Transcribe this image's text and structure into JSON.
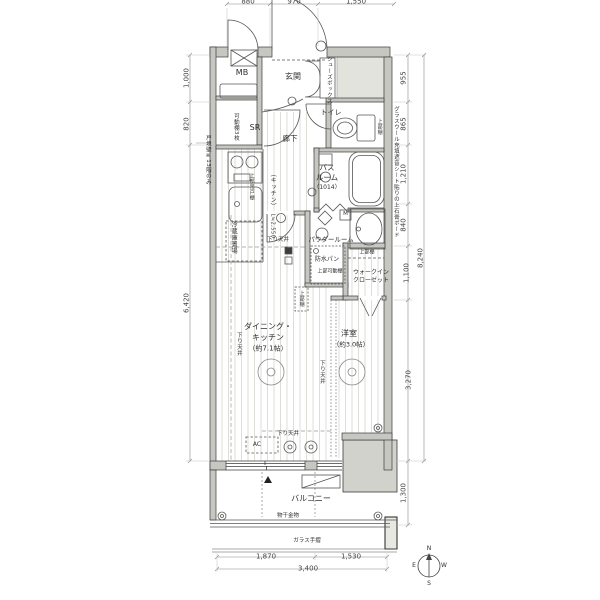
{
  "rooms": {
    "mb": "MB",
    "genkan": "玄関",
    "shoes_box": "シューズボックス",
    "toilet": "トイレ",
    "sr": "SR",
    "hallway": "廊下",
    "bath_1": "バス",
    "bath_2": "ルーム",
    "bath_size": "（1014）",
    "powder": "パウダールーム",
    "wic_1": "ウォークイン",
    "wic_2": "クローゼット",
    "dk_1": "ダイニング・",
    "dk_2": "キッチン",
    "dk_size": "（約7.1帖）",
    "bedroom": "洋室",
    "bedroom_size": "（約3.0帖）",
    "balcony": "バルコニー"
  },
  "notes": {
    "movable_shelf": "可動棚3枚",
    "upper_shelf": "上部棚",
    "upper_movable_shelf": "上部可動棚",
    "upper_hanging_cabinet": "上部吊戸棚",
    "kitchen": "（キッチン）",
    "kitchen_length": "L≒2,550",
    "fridge": "冷蔵庫置場",
    "waterproof_pan": "防水パン",
    "lowered_ceiling": "下り天井",
    "ac": "AC",
    "meter": "M",
    "laundry_hook": "物干金物",
    "glass_rail": "ガラス手摺",
    "right_wall": "グラスウール充填遮音シート貼りの上石膏ボード",
    "left_wall": "戸境壁※13階のみ"
  },
  "dims": {
    "top": [
      "880",
      "970",
      "1,550"
    ],
    "left": [
      "1,000",
      "820",
      "6,420"
    ],
    "right": [
      "955",
      "865",
      "1,210",
      "840",
      "1,100",
      "3,270"
    ],
    "right_total": "8,240",
    "balcony_depth": "1,300",
    "bottom": [
      "1,870",
      "1,530"
    ],
    "bottom_total": "3,400"
  },
  "compass": {
    "n": "N",
    "e": "E",
    "s": "S",
    "w": "W"
  }
}
